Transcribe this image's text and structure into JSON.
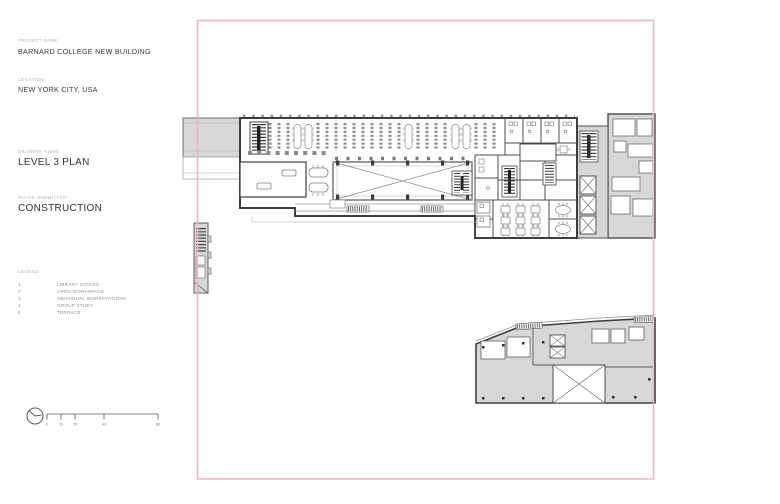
{
  "title_block": {
    "project_name_label": "PROJECT NAME",
    "project_name": "BARNARD COLLEGE NEW BUILDING",
    "location_label": "LOCATION",
    "location": "NEW YORK CITY, USA",
    "drawing_name_label": "DRAWING NAME",
    "drawing_name": "LEVEL 3 PLAN",
    "phase_label": "PHASE SUBMITTED",
    "phase": "CONSTRUCTION"
  },
  "legend": {
    "label": "LEGEND",
    "items": [
      {
        "number": "1",
        "label": "LIBRARY STACKS"
      },
      {
        "number": "2",
        "label": "OPEN WORKSPACE"
      },
      {
        "number": "3",
        "label": "INDIVIDUAL WORKSTATIONS"
      },
      {
        "number": "4",
        "label": "GROUP STUDY"
      },
      {
        "number": "5",
        "label": "TERRACE"
      }
    ]
  },
  "scale_bar": {
    "ticks": [
      "0",
      "10",
      "20",
      "40",
      "80"
    ]
  },
  "colors": {
    "border_pink": "#f2b4bc",
    "building_fill_gray": "#d7d7d7",
    "wall_dark": "#3d3d40",
    "line_medium": "#6f6f6f",
    "label_gray": "#b4b4b4",
    "text_dark": "#3a3a3a"
  }
}
